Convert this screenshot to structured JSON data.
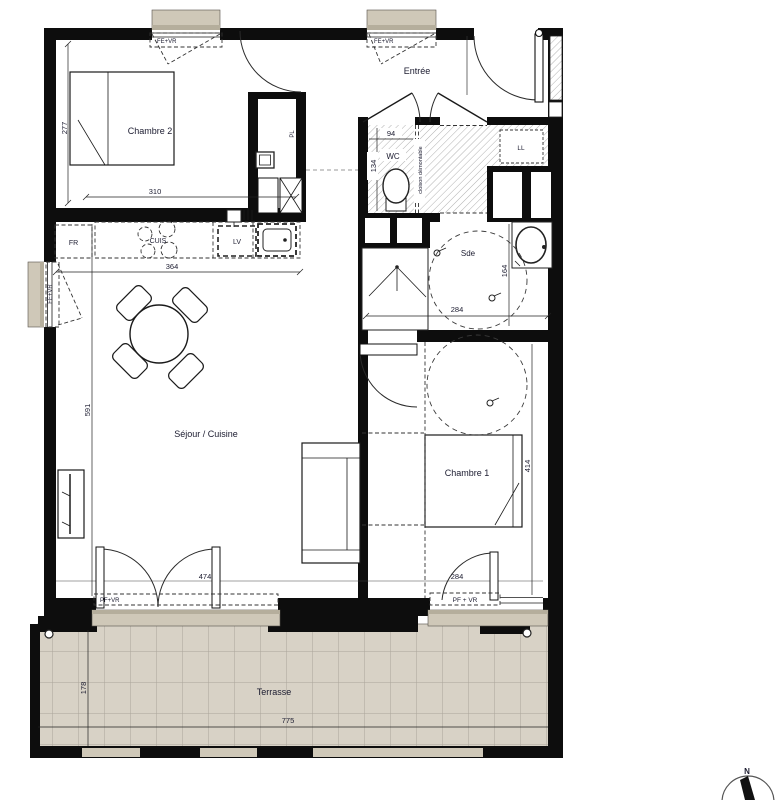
{
  "labels": {
    "chambre2": "Chambre 2",
    "chambre1": "Chambre 1",
    "entree": "Entrée",
    "wc": "WC",
    "sde": "Sde",
    "sejour_cuisine": "Séjour / Cuisine",
    "terrasse": "Terrasse",
    "placard": "PL",
    "fridge": "FR",
    "cooktop": "CUIS",
    "dishwasher": "LV",
    "washer": "LL",
    "partition": "cloison démontable",
    "north": "N"
  },
  "windows": {
    "fe_vr": "FE+VR",
    "pf_vr": "PF+VR",
    "pf_vr_spaced": "PF + VR"
  },
  "dims": {
    "chambre2_h": "277",
    "chambre2_w": "310",
    "kitchen": "364",
    "sejour_h": "591",
    "sejour_opening": "474",
    "wc_w": "94",
    "wc_h": "134",
    "sde_w": "284",
    "sde_h": "164",
    "chambre1_h": "414",
    "chambre1_opening": "284",
    "terrasse_w": "775",
    "terrasse_h": "178"
  },
  "colors": {
    "wall": "#0d0d0d",
    "sill": "#cfc8b8",
    "sill_dark": "#b5ae9c",
    "terrace_tile": "#d8d2c6",
    "tile_line": "#aaa49a",
    "text": "#1c1c30"
  }
}
